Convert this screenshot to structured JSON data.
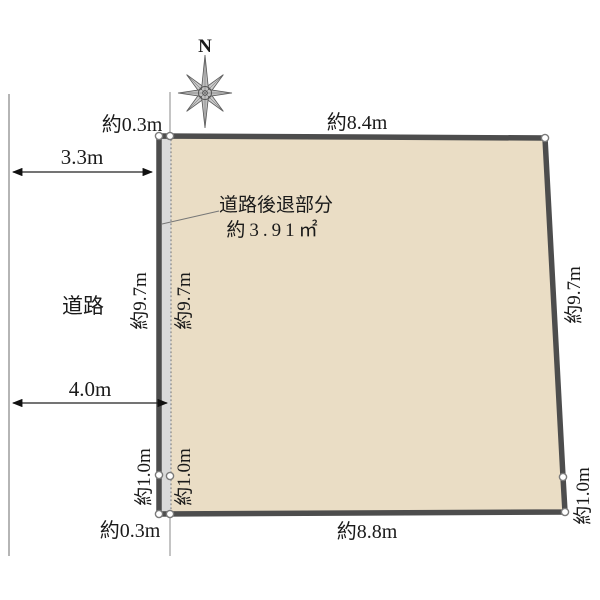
{
  "canvas": {
    "width": "600",
    "height": "600",
    "background": "#ffffff"
  },
  "colors": {
    "plot_fill": "#eaddc5",
    "plot_outline": "#4d4d4d",
    "setback_fill": "#dadada",
    "dotted_line": "#8f8f8f"
  },
  "compass": {
    "north_label": "N"
  },
  "road": {
    "label": "道路",
    "existing_width": "3.3m",
    "widened_width": "4.0m"
  },
  "setback": {
    "title": "道路後退部分",
    "area": "約3.91㎡",
    "top_width": "約0.3m",
    "bottom_width": "約0.3m"
  },
  "plot_edges": {
    "top": "約8.4m",
    "bottom": "約8.8m",
    "left_outer": "約9.7m",
    "left_inner": "約9.7m",
    "right": "約9.7m",
    "left_lower_outer": "約1.0m",
    "left_lower_inner": "約1.0m",
    "right_lower": "約1.0m"
  }
}
